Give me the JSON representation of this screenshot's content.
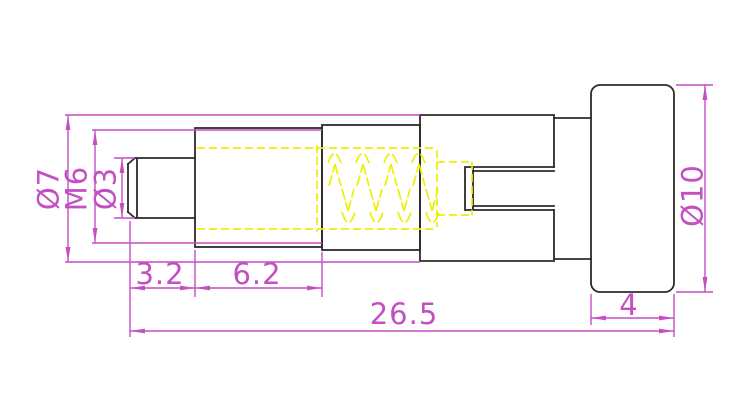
{
  "drawing": {
    "dims": {
      "dia7": "Ø7",
      "m6": "M6",
      "dia3": "Ø3",
      "seg_3_2": "3.2",
      "seg_6_2": "6.2",
      "total_26_5": "26.5",
      "knob_4": "4",
      "dia10": "Ø10"
    },
    "colors": {
      "dimension_magenta": "#c34fc3",
      "hidden_yellow": "#efef00",
      "outline_black": "#2d2a2b",
      "background": "#ffffff"
    }
  }
}
